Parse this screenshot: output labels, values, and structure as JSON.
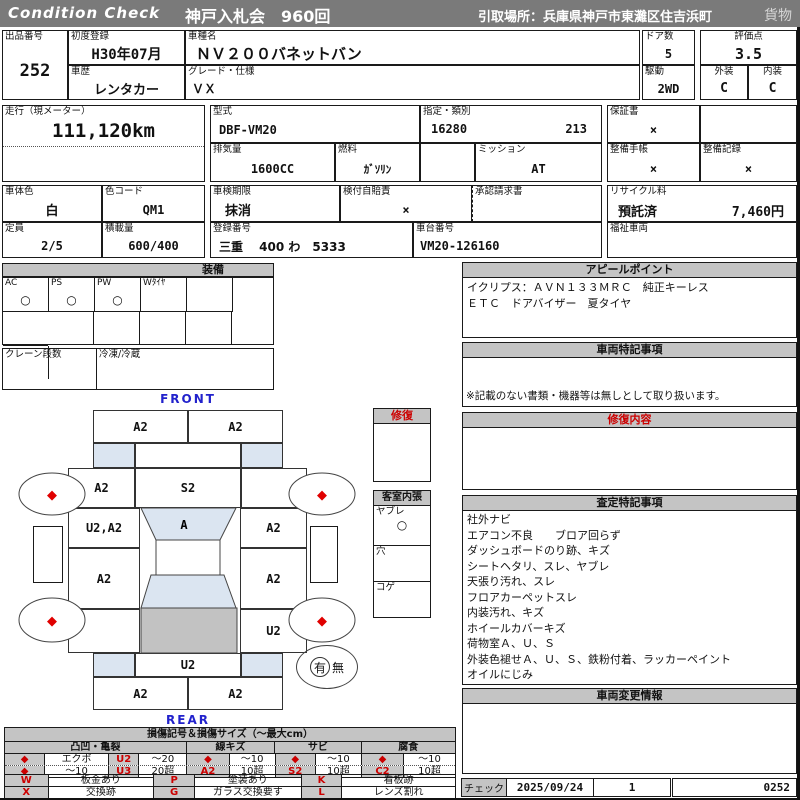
{
  "header": {
    "brand": "Condition Check",
    "auction": "神戸入札会　960回",
    "pickup": "引取場所：兵庫県神戸市東灘区住吉浜町",
    "category": "貨物"
  },
  "info": {
    "lot_label": "出品番号",
    "lot": "252",
    "first_reg_label": "初度登録",
    "first_reg": "H30年07月",
    "history_label": "車歴",
    "history": "レンタカー",
    "model_name_label": "車種名",
    "model_name": "ＮＶ２００バネットバン",
    "grade_label": "グレード・仕様",
    "grade": "ＶＸ",
    "doors_label": "ドア数",
    "doors": "5",
    "drive_label": "駆動",
    "drive": "2WD",
    "score_label": "評価点",
    "score": "3.5",
    "exterior_label": "外装",
    "exterior": "C",
    "interior_label": "内装",
    "interior": "C"
  },
  "spec": {
    "odo_label": "走行（現メーター）",
    "odo": "111,120km",
    "model_code_label": "型式",
    "model_code": "DBF-VM20",
    "class_label": "指定・類別",
    "class_no": "16280",
    "class_no2": "213",
    "warranty_label": "保証書",
    "warranty": "×",
    "displacement_label": "排気量",
    "displacement": "1600CC",
    "fuel_label": "燃料",
    "fuel": "ｶﾞｿﾘﾝ",
    "mission_label": "ミッション",
    "mission": "AT",
    "maint_book_label": "整備手帳",
    "maint_book": "×",
    "maint_record_label": "整備記録",
    "maint_record": "×",
    "color_label": "車体色",
    "color": "白",
    "color_code_label": "色コード",
    "color_code": "QM1",
    "capacity_label": "定員",
    "capacity": "2/5",
    "load_label": "積載量",
    "load": "600/400",
    "inspection_label": "車検期限",
    "inspection": "抹消",
    "insurance_label": "検付自賠責",
    "insurance": "×",
    "approval_label": "承認請求書",
    "recycle_label": "リサイクル料",
    "recycle_status": "預託済",
    "recycle_fee": "7,460円",
    "reg_no_label": "登録番号",
    "reg_no": "三重　 400 わ　5333",
    "chassis_label": "車台番号",
    "chassis": "VM20-126160",
    "welfare_label": "福祉車両"
  },
  "equipment": {
    "title": "装備",
    "items": [
      {
        "label": "AC",
        "value": "○"
      },
      {
        "label": "PS",
        "value": "○"
      },
      {
        "label": "PW",
        "value": "○"
      },
      {
        "label": "Wﾀｲﾔ",
        "value": ""
      },
      {
        "label": "",
        "value": ""
      },
      {
        "label": "",
        "value": ""
      }
    ],
    "crane_label": "クレーン段数",
    "crane": "",
    "freezer_label": "冷凍/冷蔵",
    "freezer": ""
  },
  "diagram": {
    "front_label": "FRONT",
    "rear_label": "REAR",
    "front_bumper_l": "A2",
    "front_bumper_r": "A2",
    "left_fender": "A2",
    "hood": "S2",
    "right_fender": "",
    "left_door": "U2,A2",
    "windshield": "A",
    "right_door": "A2",
    "left_slide": "A2",
    "right_slide": "A2",
    "left_rear_fender": "",
    "right_rear_fender": "U2",
    "rear_gate": "U2",
    "rear_bumper_l": "A2",
    "rear_bumper_r": "A2",
    "wheel_mark": "◆",
    "presence": {
      "yes": "有",
      "no": "無"
    },
    "repair_box_label": "修復",
    "interior_box": {
      "title": "客室内張",
      "rows": [
        {
          "label": "ヤブレ",
          "value": "○"
        },
        {
          "label": "穴",
          "value": ""
        },
        {
          "label": "コゲ",
          "value": ""
        }
      ]
    }
  },
  "sections": {
    "appeal": {
      "title": "アピールポイント",
      "lines": [
        "イクリプス：ＡＶＮ１３３ＭＲＣ　純正キーレス",
        "ＥＴＣ　ドアバイザー　夏タイヤ"
      ]
    },
    "notes": {
      "title": "車両特記事項",
      "footer": "※記載のない書類・機器等は無しとして取り扱います。"
    },
    "repair": {
      "title": "修復内容"
    },
    "assessment": {
      "title": "査定特記事項",
      "lines": [
        "社外ナビ",
        "エアコン不良　　ブロア回らず",
        "ダッシュボードのり跡、キズ",
        "シートヘタリ、スレ、ヤブレ",
        "天張り汚れ、スレ",
        "フロアカーペットスレ",
        "内装汚れ、キズ",
        "ホイールカバーキズ",
        "荷物室Ａ、Ｕ、Ｓ",
        "外装色褪せＡ、Ｕ、Ｓ、鉄粉付着、ラッカーペイント",
        "オイルにじみ"
      ]
    },
    "changes": {
      "title": "車両変更情報"
    }
  },
  "legend": {
    "title": "損傷記号＆損傷サイズ（～最大cm）",
    "groups": [
      "凸凹・亀裂",
      "線キズ",
      "サビ",
      "腐食"
    ],
    "rows": [
      [
        "◆",
        "エクボ",
        "U2",
        "～20",
        "◆",
        "～10",
        "◆",
        "～10",
        "◆",
        "～10"
      ],
      [
        "◆",
        "～10",
        "U3",
        "20超",
        "A2",
        "10超",
        "S2",
        "10超",
        "C2",
        "10超"
      ]
    ],
    "rows2": [
      [
        "W",
        "板金あり",
        "P",
        "塗装あり",
        "K",
        "看板跡"
      ],
      [
        "X",
        "交換跡",
        "G",
        "ガラス交換要す",
        "L",
        "レンズ割れ"
      ]
    ]
  },
  "footer": {
    "check_label": "チェック",
    "date": "2025/09/24",
    "count": "1",
    "code": "0252"
  },
  "colors": {
    "accent_red": "#cc0000",
    "header_gray": "#7a7a7a",
    "bar_gray": "#c4c4c4",
    "glass_blue": "#dbe5f1",
    "roof_gray": "#c2c2c2",
    "label_blue": "#2222cc"
  }
}
